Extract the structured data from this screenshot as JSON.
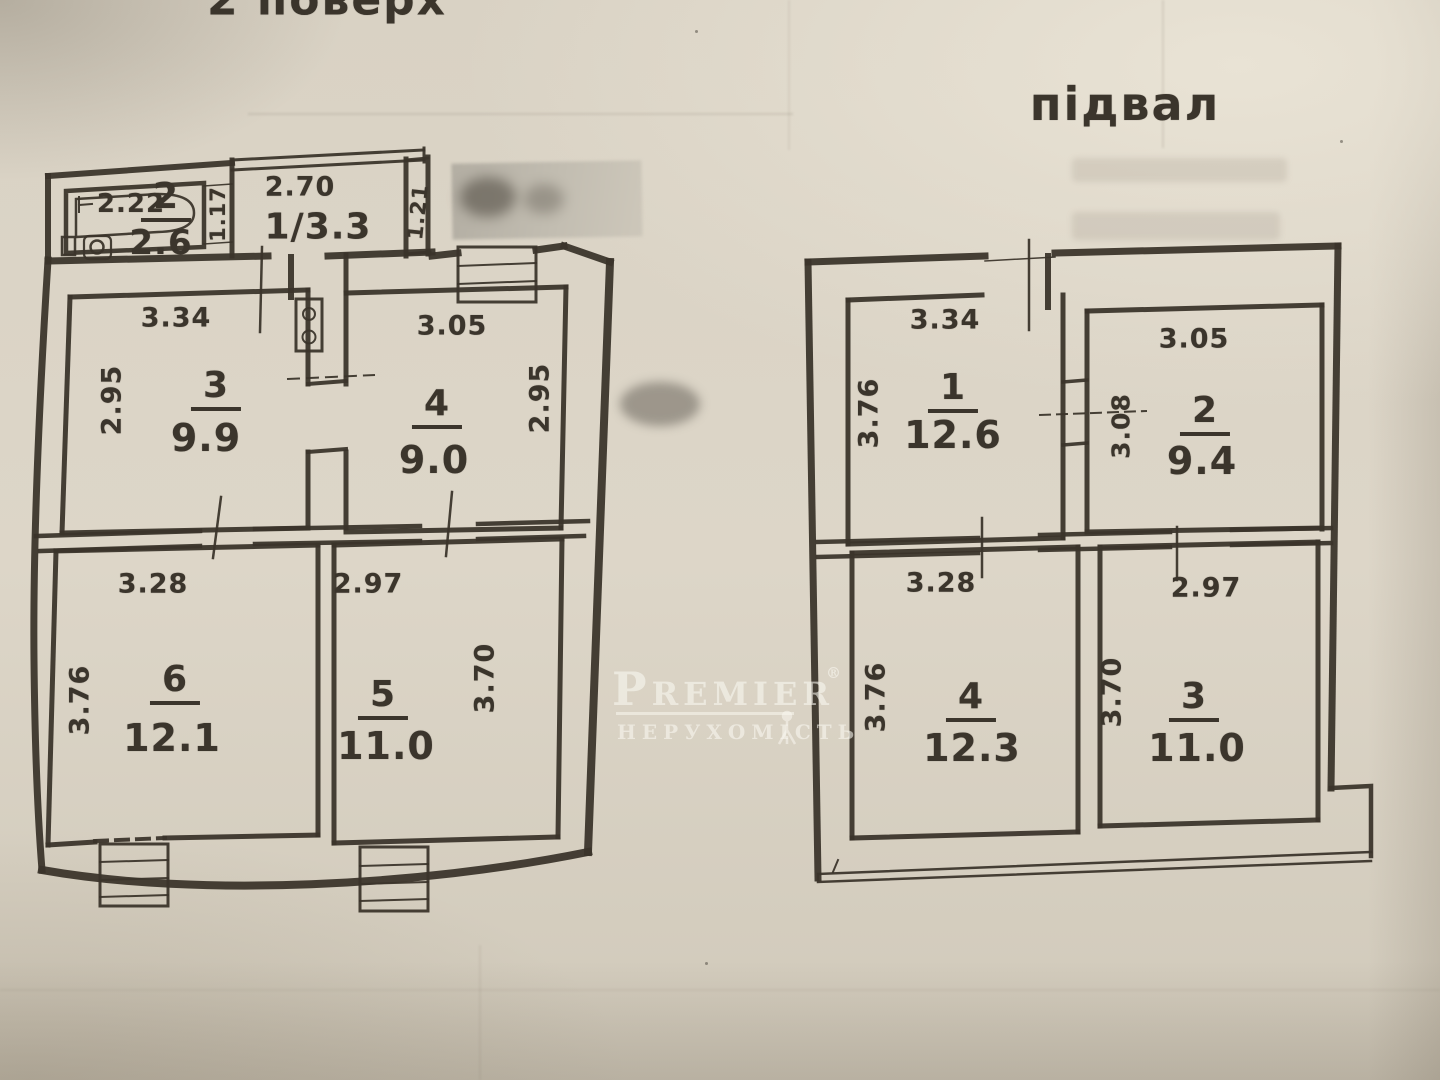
{
  "colors": {
    "paper": "#d9d2c4",
    "ink": "#3a342b",
    "watermark": "#faf8f1"
  },
  "titles": {
    "floor2": "2 поверх",
    "basement": "підвал"
  },
  "watermark": {
    "brand": "Premier",
    "registered": "®",
    "subtitle": "нерухомість"
  },
  "floor2": {
    "bath": {
      "number": "2",
      "area": "2.6",
      "tub_width": "2.22"
    },
    "hall": {
      "number": "1/3.3",
      "width": "2.70",
      "left_height": "1.17",
      "right_height": "1.21"
    },
    "room3": {
      "number": "3",
      "area": "9.9",
      "width": "3.34",
      "height": "2.95"
    },
    "room4": {
      "number": "4",
      "area": "9.0",
      "width": "3.05",
      "height": "2.95"
    },
    "room6": {
      "number": "6",
      "area": "12.1",
      "width": "3.28",
      "height": "3.76"
    },
    "room5": {
      "number": "5",
      "area": "11.0",
      "width": "2.97",
      "height": "3.70"
    }
  },
  "basement": {
    "room1": {
      "number": "1",
      "area": "12.6",
      "width": "3.34",
      "height": "3.76"
    },
    "room2": {
      "number": "2",
      "area": "9.4",
      "width": "3.05",
      "height": "3.08"
    },
    "room4": {
      "number": "4",
      "area": "12.3",
      "width": "3.28",
      "height": "3.76"
    },
    "room3": {
      "number": "3",
      "area": "11.0",
      "width": "2.97",
      "height": "3.70"
    }
  }
}
